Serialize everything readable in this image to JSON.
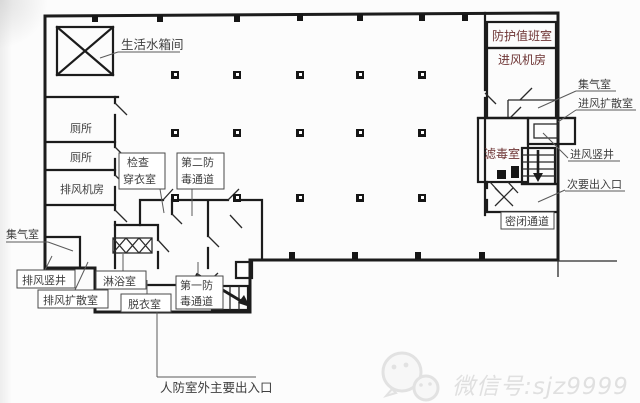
{
  "plan": {
    "labels": {
      "water_tank": "生活水箱间",
      "toilet1": "厕所",
      "toilet2": "厕所",
      "exhaust_fan_room": "排风机房",
      "check_line1": "检查",
      "check_line2": "穿衣室",
      "second_line1": "第二防",
      "second_line2": "毒通道",
      "gas_collect_left": "集气室",
      "exhaust_shaft": "排风竖井",
      "exhaust_diffusion": "排风扩散室",
      "shower": "淋浴室",
      "undress": "脱衣室",
      "first_line1": "第一防",
      "first_line2": "毒通道",
      "main_entrance": "人防室外主要出入口",
      "duty_room": "防护值班室",
      "intake_fan_room": "进风机房",
      "filter_room": "滤毒室",
      "gas_collect_right": "集气室",
      "intake_diffusion": "进风扩散室",
      "intake_shaft": "进风竖井",
      "secondary_exit": "次要出入口",
      "sealed_passage": "密闭通道"
    },
    "watermark": "微信号:sjz9999",
    "colors": {
      "room_green": "#76c83e",
      "room_blue": "#58a8d8",
      "wall": "#1c1c1c",
      "text_dark": "#3f3f3f",
      "text_room": "#6d3333",
      "watermark": "#e0e0e0"
    }
  }
}
